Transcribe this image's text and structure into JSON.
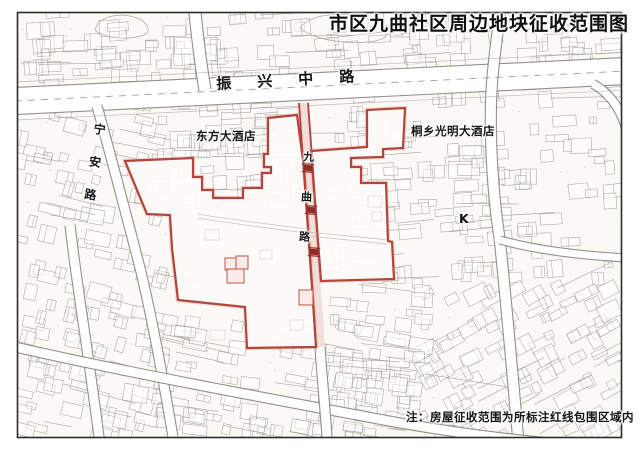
{
  "title": "市区九曲社区周边地块征收范围图",
  "note": "注：房屋征收范围为所标注红线包围区域内",
  "labels": {
    "road_main": "振兴中路",
    "road_west": "宁安路",
    "road_center": "九曲路",
    "hotel_west": "东方大酒店",
    "hotel_east": "桐乡光明大酒店",
    "landmark": "K"
  },
  "colors": {
    "paper": "#faf9f6",
    "boundary_red": "#b2453c",
    "boundary_glow": "#e4a79e",
    "road_pink": "#f2dcd7",
    "marker_dark_red": "#8e2b24",
    "building_red": "#c0544a",
    "building_red_fill": "#fbeae7",
    "fabric_gray": "#a8a49d",
    "line_gray": "#9d9992",
    "road_gray": "#8e8a84",
    "frame": "#2b2b2b",
    "parcel_fill": "#fdfbf9"
  },
  "map_data": {
    "frame": {
      "x": 17,
      "y": 12,
      "w": 605,
      "h": 426
    },
    "parcels": [
      {
        "name": "acquisition-parcel-west",
        "points": [
          [
            125,
            161
          ],
          [
            193,
            158
          ],
          [
            193,
            177
          ],
          [
            202,
            177
          ],
          [
            202,
            190
          ],
          [
            213,
            190
          ],
          [
            213,
            198
          ],
          [
            243,
            198
          ],
          [
            243,
            188
          ],
          [
            262,
            188
          ],
          [
            262,
            173
          ],
          [
            271,
            173
          ],
          [
            271,
            167
          ],
          [
            264,
            167
          ],
          [
            264,
            154
          ],
          [
            268,
            154
          ],
          [
            268,
            118
          ],
          [
            297,
            115
          ],
          [
            304,
            168
          ],
          [
            313,
            300
          ],
          [
            316,
            347
          ],
          [
            247,
            348
          ],
          [
            245,
            307
          ],
          [
            178,
            300
          ],
          [
            172,
            248
          ],
          [
            170,
            215
          ],
          [
            147,
            214
          ]
        ]
      },
      {
        "name": "acquisition-parcel-east",
        "points": [
          [
            311,
            151
          ],
          [
            367,
            147
          ],
          [
            367,
            110
          ],
          [
            405,
            108
          ],
          [
            403,
            148
          ],
          [
            383,
            149
          ],
          [
            383,
            157
          ],
          [
            351,
            158
          ],
          [
            351,
            167
          ],
          [
            361,
            167
          ],
          [
            361,
            183
          ],
          [
            386,
            183
          ],
          [
            388,
            241
          ],
          [
            392,
            242
          ],
          [
            394,
            279
          ],
          [
            321,
            281
          ]
        ]
      }
    ],
    "road_corridor": {
      "fill_points": [
        [
          299,
          103
        ],
        [
          308,
          103
        ],
        [
          325,
          347
        ],
        [
          316,
          347
        ]
      ],
      "left_edge": [
        [
          299,
          103
        ],
        [
          316,
          347
        ]
      ],
      "right_edge": [
        [
          308,
          103
        ],
        [
          321,
          281
        ]
      ]
    },
    "road_markers": [
      [
        308,
        168
      ],
      [
        311,
        210
      ],
      [
        314,
        252
      ]
    ],
    "red_buildings": [
      [
        225,
        258,
        11,
        12
      ],
      [
        236,
        256,
        12,
        13
      ],
      [
        227,
        269,
        17,
        14
      ],
      [
        299,
        290,
        14,
        15
      ]
    ],
    "faint_paths": [
      "M197,214 C235,220 275,225 306,229",
      "M197,218 C235,224 275,229 306,233",
      "M300,231 C335,235 362,237 387,240",
      "M300,235 C335,239 362,241 387,244"
    ],
    "faint_buildings": [
      [
        368,
        196,
        14,
        11
      ],
      [
        372,
        212,
        10,
        9
      ],
      [
        205,
        230,
        14,
        10
      ],
      [
        260,
        250,
        12,
        9
      ],
      [
        290,
        320,
        13,
        10
      ],
      [
        210,
        330,
        15,
        10
      ]
    ],
    "streets": [
      {
        "d": "M15,101 L627,71",
        "w": 26,
        "main": true
      },
      {
        "d": "M97,106 C112,160 126,214 139,264 C151,312 162,372 173,437",
        "w": 9
      },
      {
        "d": "M70,225 C76,280 88,350 99,437",
        "w": 9
      },
      {
        "d": "M500,13 C496,45 492,72 491,102 C490,152 494,202 500,242 C506,300 512,368 518,437",
        "w": 10
      },
      {
        "d": "M195,13 C198,42 201,66 205,90",
        "w": 11
      },
      {
        "d": "M15,347 C120,371 260,397 400,423 C480,437 550,444 625,449",
        "w": 9
      },
      {
        "d": "M500,240 C532,249 572,255 627,258",
        "w": 7
      },
      {
        "d": "M593,84 C610,93 620,108 626,128",
        "w": 8
      },
      {
        "d": "M320,347 C322,377 325,407 327,437",
        "w": 9
      }
    ],
    "main_road_side_lines": [
      "M15,82 L627,52",
      "M15,120 L627,90"
    ],
    "main_road_center": "M15,101 L627,71",
    "ponds": [
      "M95,30 C98,18 115,13 130,16 C145,19 152,28 146,34 C135,40 105,40 95,30 Z",
      "M300,28 C310,14 340,12 360,17 C380,22 392,30 384,38 C370,46 318,44 300,28 Z"
    ]
  }
}
